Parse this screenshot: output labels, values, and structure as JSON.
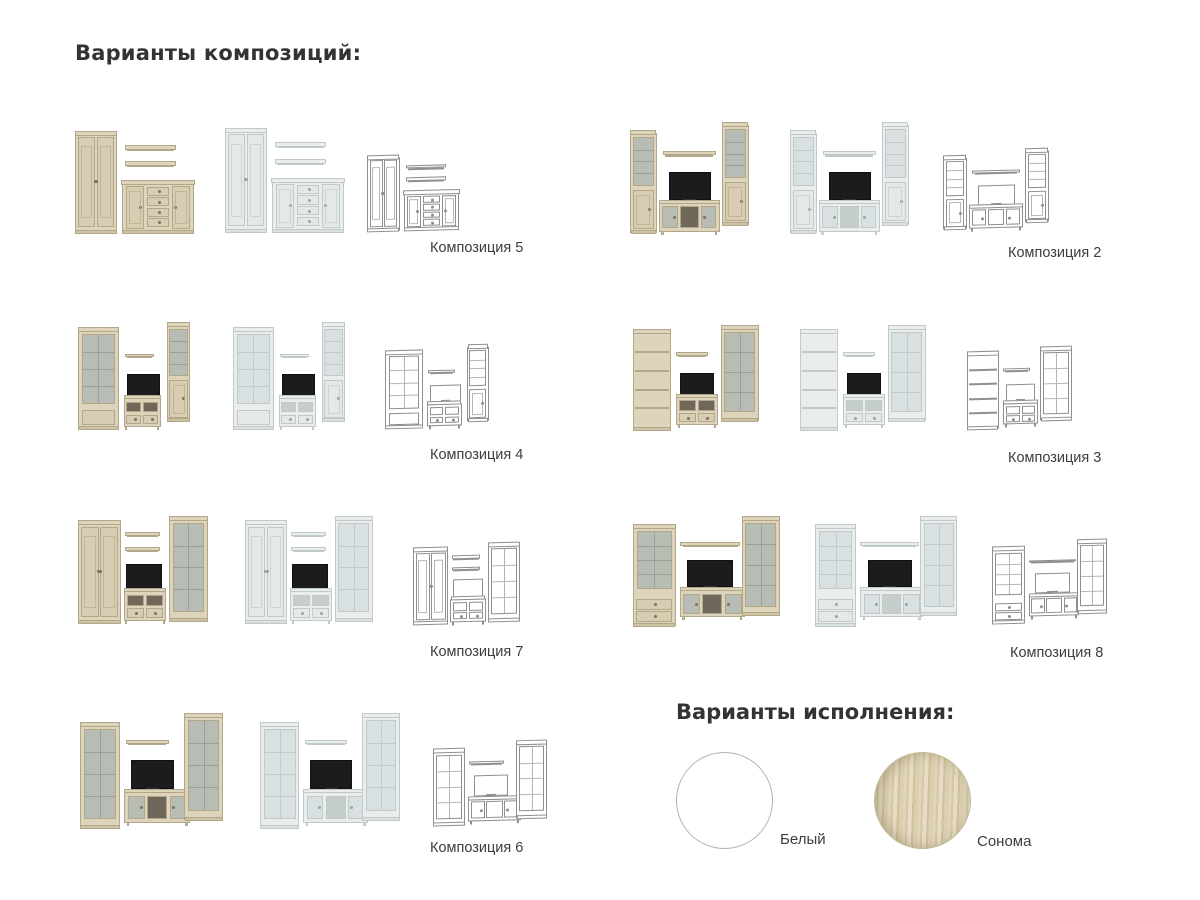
{
  "header": {
    "title": "Варианты композиций:"
  },
  "compositions": [
    {
      "id": 5,
      "label": "Композиция 5"
    },
    {
      "id": 2,
      "label": "Композиция 2"
    },
    {
      "id": 4,
      "label": "Композиция 4"
    },
    {
      "id": 3,
      "label": "Композиция 3"
    },
    {
      "id": 7,
      "label": "Композиция 7"
    },
    {
      "id": 8,
      "label": "Композиция 8"
    },
    {
      "id": 6,
      "label": "Композиция 6"
    }
  ],
  "render_variants": [
    "sonoma",
    "white",
    "wireframe"
  ],
  "finishes": {
    "title": "Варианты исполнения:",
    "options": [
      {
        "label": "Белый",
        "color": "#ffffff"
      },
      {
        "label": "Сонома",
        "color": "#d7caa8"
      }
    ]
  },
  "colors": {
    "sonoma_wood": "#ded4bc",
    "white_furniture": "#e9edec",
    "wireframe_line": "#8f8f8f",
    "text": "#363636"
  }
}
